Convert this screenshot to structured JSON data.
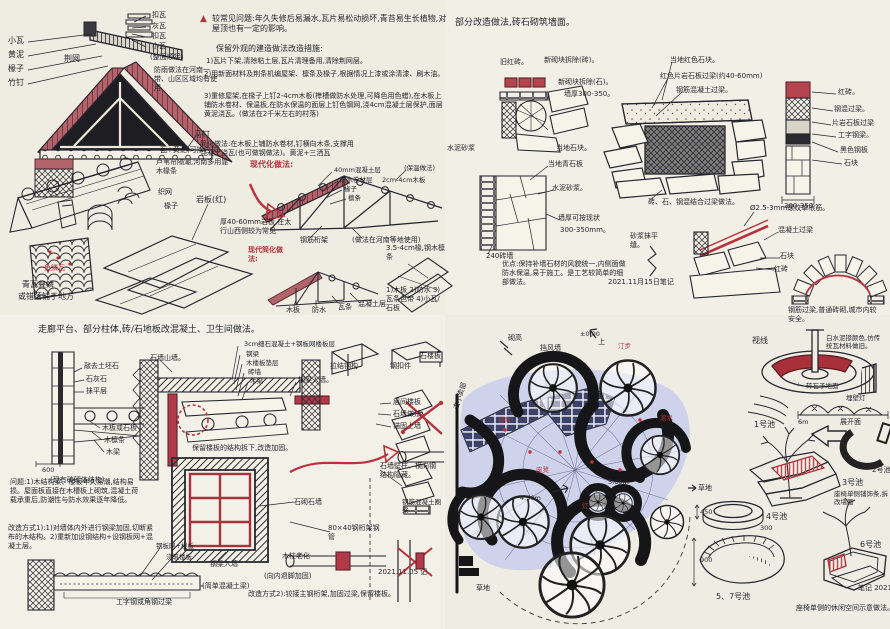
{
  "colors": {
    "paper": "#f0ede3",
    "ink": "#26262e",
    "red_ink": "#b8323e",
    "roof_red": "#b2636b",
    "lavender": "#ced2ea",
    "navy_brick": "#3d4268"
  },
  "tl": {
    "tri": "▲",
    "h1": "较常见问题:年久失修后易漏水,瓦片易松动损坏,青苔易生长植物,对屋顶也有一定的影响。",
    "h2": "保留外观的建造做法改造措施:",
    "li1": "1)瓦片下架,清除粘土层,瓦片清理备用,清除荆网层。",
    "li2": "2)用新面材料及荆条机编屋架、檩条及椽子,根据情况上漆或涂清漆、刷木油。",
    "li3": "3)重修屋架,在椽子上钉2-4cm木板(榫槽做防水处理,可降色用色蜡),在木板上铺防水卷材、保温板,在防水保温的面层上钉色钢网,浇4cm混凝土层保护,面层黄泥浇瓦。(做法在2千米左右的村落)",
    "li4": "简化做法:在木板上铺防水卷材,钉横向木条,支撑用混凝土浇瓦(也可做钢做法)。黄泥+三洒瓦",
    "xiaowa": "小瓦",
    "huangni": "黄泥",
    "chuanzi": "椽子",
    "zhuding": "竹钉",
    "jingwang": "荆网",
    "kouwa": "扣瓦",
    "huiwa": "灰瓦",
    "kouwa2": "扣瓦",
    "xiaowa2": "小瓦",
    "shunjie": "(整面顺接)",
    "note_fangyu": "防雨做法在河南一带、山区区域均有使用",
    "mading": "马钉",
    "wa_huangni": "瓦+黄泥(可掺白灰)",
    "luwei": "芦苇帘隔潮,河南多用靠木椽条",
    "zhiwang": "织网",
    "chuanzi2": "椽子",
    "yanban": "岩板(红)",
    "yanban_note": "厚40-60mm岩板,在太行山西侧较为常见",
    "red_jianhua": "现代简化做法:",
    "red_xiandai": "现代化做法:",
    "t1a": "40mm混凝土层",
    "t1b": "防水卷材层",
    "t1c": "2cm-4cm木板",
    "t1d": "椽子",
    "t1e": "檩条",
    "t1f": "(保温做法)",
    "gangjin": "钢筋桁架",
    "henan": "(做法在河南等地使用)",
    "t2a": "木板",
    "t2b": "防水",
    "t2c": "瓦条",
    "t2d": "混凝土层",
    "listR": "1)木板 2)防水 3)瓦条色带 4)小瓦/石板",
    "chuan34": "3.5-4cm椽,钢木檩条",
    "yulin": "鱼鳞瓦",
    "diejiang1": "青瓦叠鳞",
    "diejiang2": "或错落铺于地方"
  },
  "tr": {
    "head": "部分改造做法,砖石砌筑墙面。",
    "jiuhong": "旧红砖。",
    "xinqi_z": "新砌块拆除(砖)。",
    "xinqi_s": "新砌块拆除(石)。",
    "qianghou": "墙厚300-350。",
    "shuini": "水泥砂浆",
    "dangdi_s": "当地石块。",
    "dangdi_h": "当地红色石块。",
    "pianyan": "红色片岩石板过梁(约40-60mm)",
    "ganghun": "钢筋混凝土过梁。",
    "zsg": "砖、石、钢混结合过梁做法。",
    "hongzhuan": "红砖。",
    "ganghun2": "钢混过梁。",
    "pianyan2": "片岩石板过梁",
    "gongzi": "工字钢梁。",
    "heise": "黑色钢板",
    "shikuai": "石块",
    "dim1": "300-350",
    "qingshi": "当地青石板",
    "shuini2": "水泥砂浆。",
    "qh2a": "墙厚可按现状",
    "qh2b": "300-350mm。",
    "zq240": "240砖墙",
    "youdian": "优点:保持补墙石材的风貌统一,内侧面做防水保温,易于施工。是工艺较简单的细部做法。",
    "shajiang": "砂浆抹平缝。",
    "date": "2021.11月15日笔记",
    "luowen": "Ø2.5-3mm螺纹单根筋。",
    "hnt": "混凝土过梁",
    "shikuai2": "石块",
    "hongzhuan2": "红砖",
    "gjgl": "钢筋过梁,普通砖砌,城市内较安全。"
  },
  "bl": {
    "head": "走廊平台、部分柱体,砖/石地板改混凝土、卫生间做法。",
    "qiaoqu": "敲去土坯石",
    "shihui": "石灰石",
    "moping": "抹平层",
    "muban": "木板或石板",
    "mulin": "木檩条",
    "muliang": "木梁",
    "dim600": "600",
    "xianyou": "(现有砖砌体结构)",
    "shiqiang": "石墙山墙。",
    "top1": "3cm细石混凝土+钢板网楼板层",
    "top2": "钢梁",
    "top3": "木楼板垫层",
    "top4": "砖墙",
    "top5": "木梁",
    "glrq": "钢梁入墙。",
    "lajie": "拉结钢构",
    "gkj": "钢扣件",
    "slb": "石楼板",
    "r1": "层间楼板",
    "r2": "石墙做法",
    "r3": "锚固上墙",
    "baoliu": "保留楼板的结构拆下,改造加固。",
    "wenti": "问题:1)木结构梁、楼板年久易潮,结构易损。屋面板直接在木槽板上砌筑,混凝土荷载承重后,防潮性与防水效果逐年降低。",
    "gaizao": "改造方式1):1)对墙体内外进行钢梁加固,切断紧布的木结构。2)重新加设钢结构+设钢板网+混凝土层。",
    "gwlb": "钢板网+楼板",
    "jzlb": "浇筑楼板",
    "jd_liang": "(简单混凝土梁)",
    "gongzi2": "工字钢或角钢过梁",
    "shiqi2": "石砌石墙",
    "ghj": "80×40钢桁架钢管",
    "glrq2": "钢梁入墙",
    "muzhu": "木柱老化",
    "tuijiao": "(向内退脚加固)",
    "fangshi2": "改造方式2):铰接主钢桁架,加固过梁,保留楼板。",
    "bizhu": "石墙壁柱、横向钢结构隐藏。",
    "quanliang": "钢筋混凝土圈梁",
    "date": "2021.11.05 记"
  },
  "br": {
    "qigao": "砌高",
    "dangfeng": "挡风墙",
    "pm0": "±0.00",
    "shang": "上",
    "xiaomaibu": "去小卖部",
    "shixian": "视线",
    "bai": "白水泥掺颜色,仿传统瓦材料做旧。",
    "suishi": "碎石子地面",
    "maideng": "埋壁灯",
    "zhankai": "展开面",
    "m6": "6m",
    "chi1": "1号池",
    "chi2": "2号池",
    "chi3": "3号池",
    "chi4": "4号池",
    "chi57": "5、7号池",
    "chi6": "6号池",
    "caodi": "草地",
    "caodi2": "草地",
    "zuoyi": "座椅单侧铺饰条,拆改墙面",
    "xiuxian": "座椅单侧的休闲空间示意做法。",
    "dim900": "900",
    "dim450": "450",
    "dim300": "300",
    "m5": "5.00m",
    "m45": "4.50m",
    "tingbu": "汀步",
    "gunshui": "滚水",
    "zuodeng": "座凳",
    "deng": "灯",
    "taijie": "台阶",
    "note2021": "笔记 2021."
  }
}
